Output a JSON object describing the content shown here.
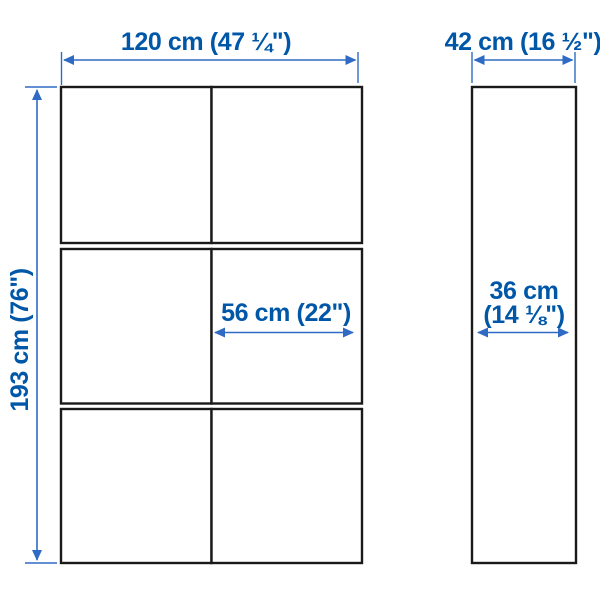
{
  "diagram_title": "storage-combination-dimension-diagram",
  "colors": {
    "background": "#ffffff",
    "product_outline": "#1a1a1a",
    "dimension_line": "#2f6bc4",
    "dimension_text": "#0057a8"
  },
  "views": {
    "front_view": {
      "columns": 2,
      "rows": 3,
      "panel_count": 6
    },
    "side_view": {
      "panel_count": 1
    }
  },
  "dimensions": {
    "overall_width": {
      "label": "120 cm (47 ¼\")",
      "cm": 120,
      "inches": "47 ¼"
    },
    "overall_height": {
      "label": "193 cm (76\")",
      "cm": 193,
      "inches": "76"
    },
    "door_width": {
      "label": "56 cm (22\")",
      "cm": 56,
      "inches": "22"
    },
    "overall_depth": {
      "label": "42 cm (16 ½\")",
      "cm": 42,
      "inches": "16 ½"
    },
    "inner_depth": {
      "label_line1": "36 cm",
      "label_line2": "(14 ⅛\")",
      "cm": 36,
      "inches": "14 ⅛"
    }
  }
}
